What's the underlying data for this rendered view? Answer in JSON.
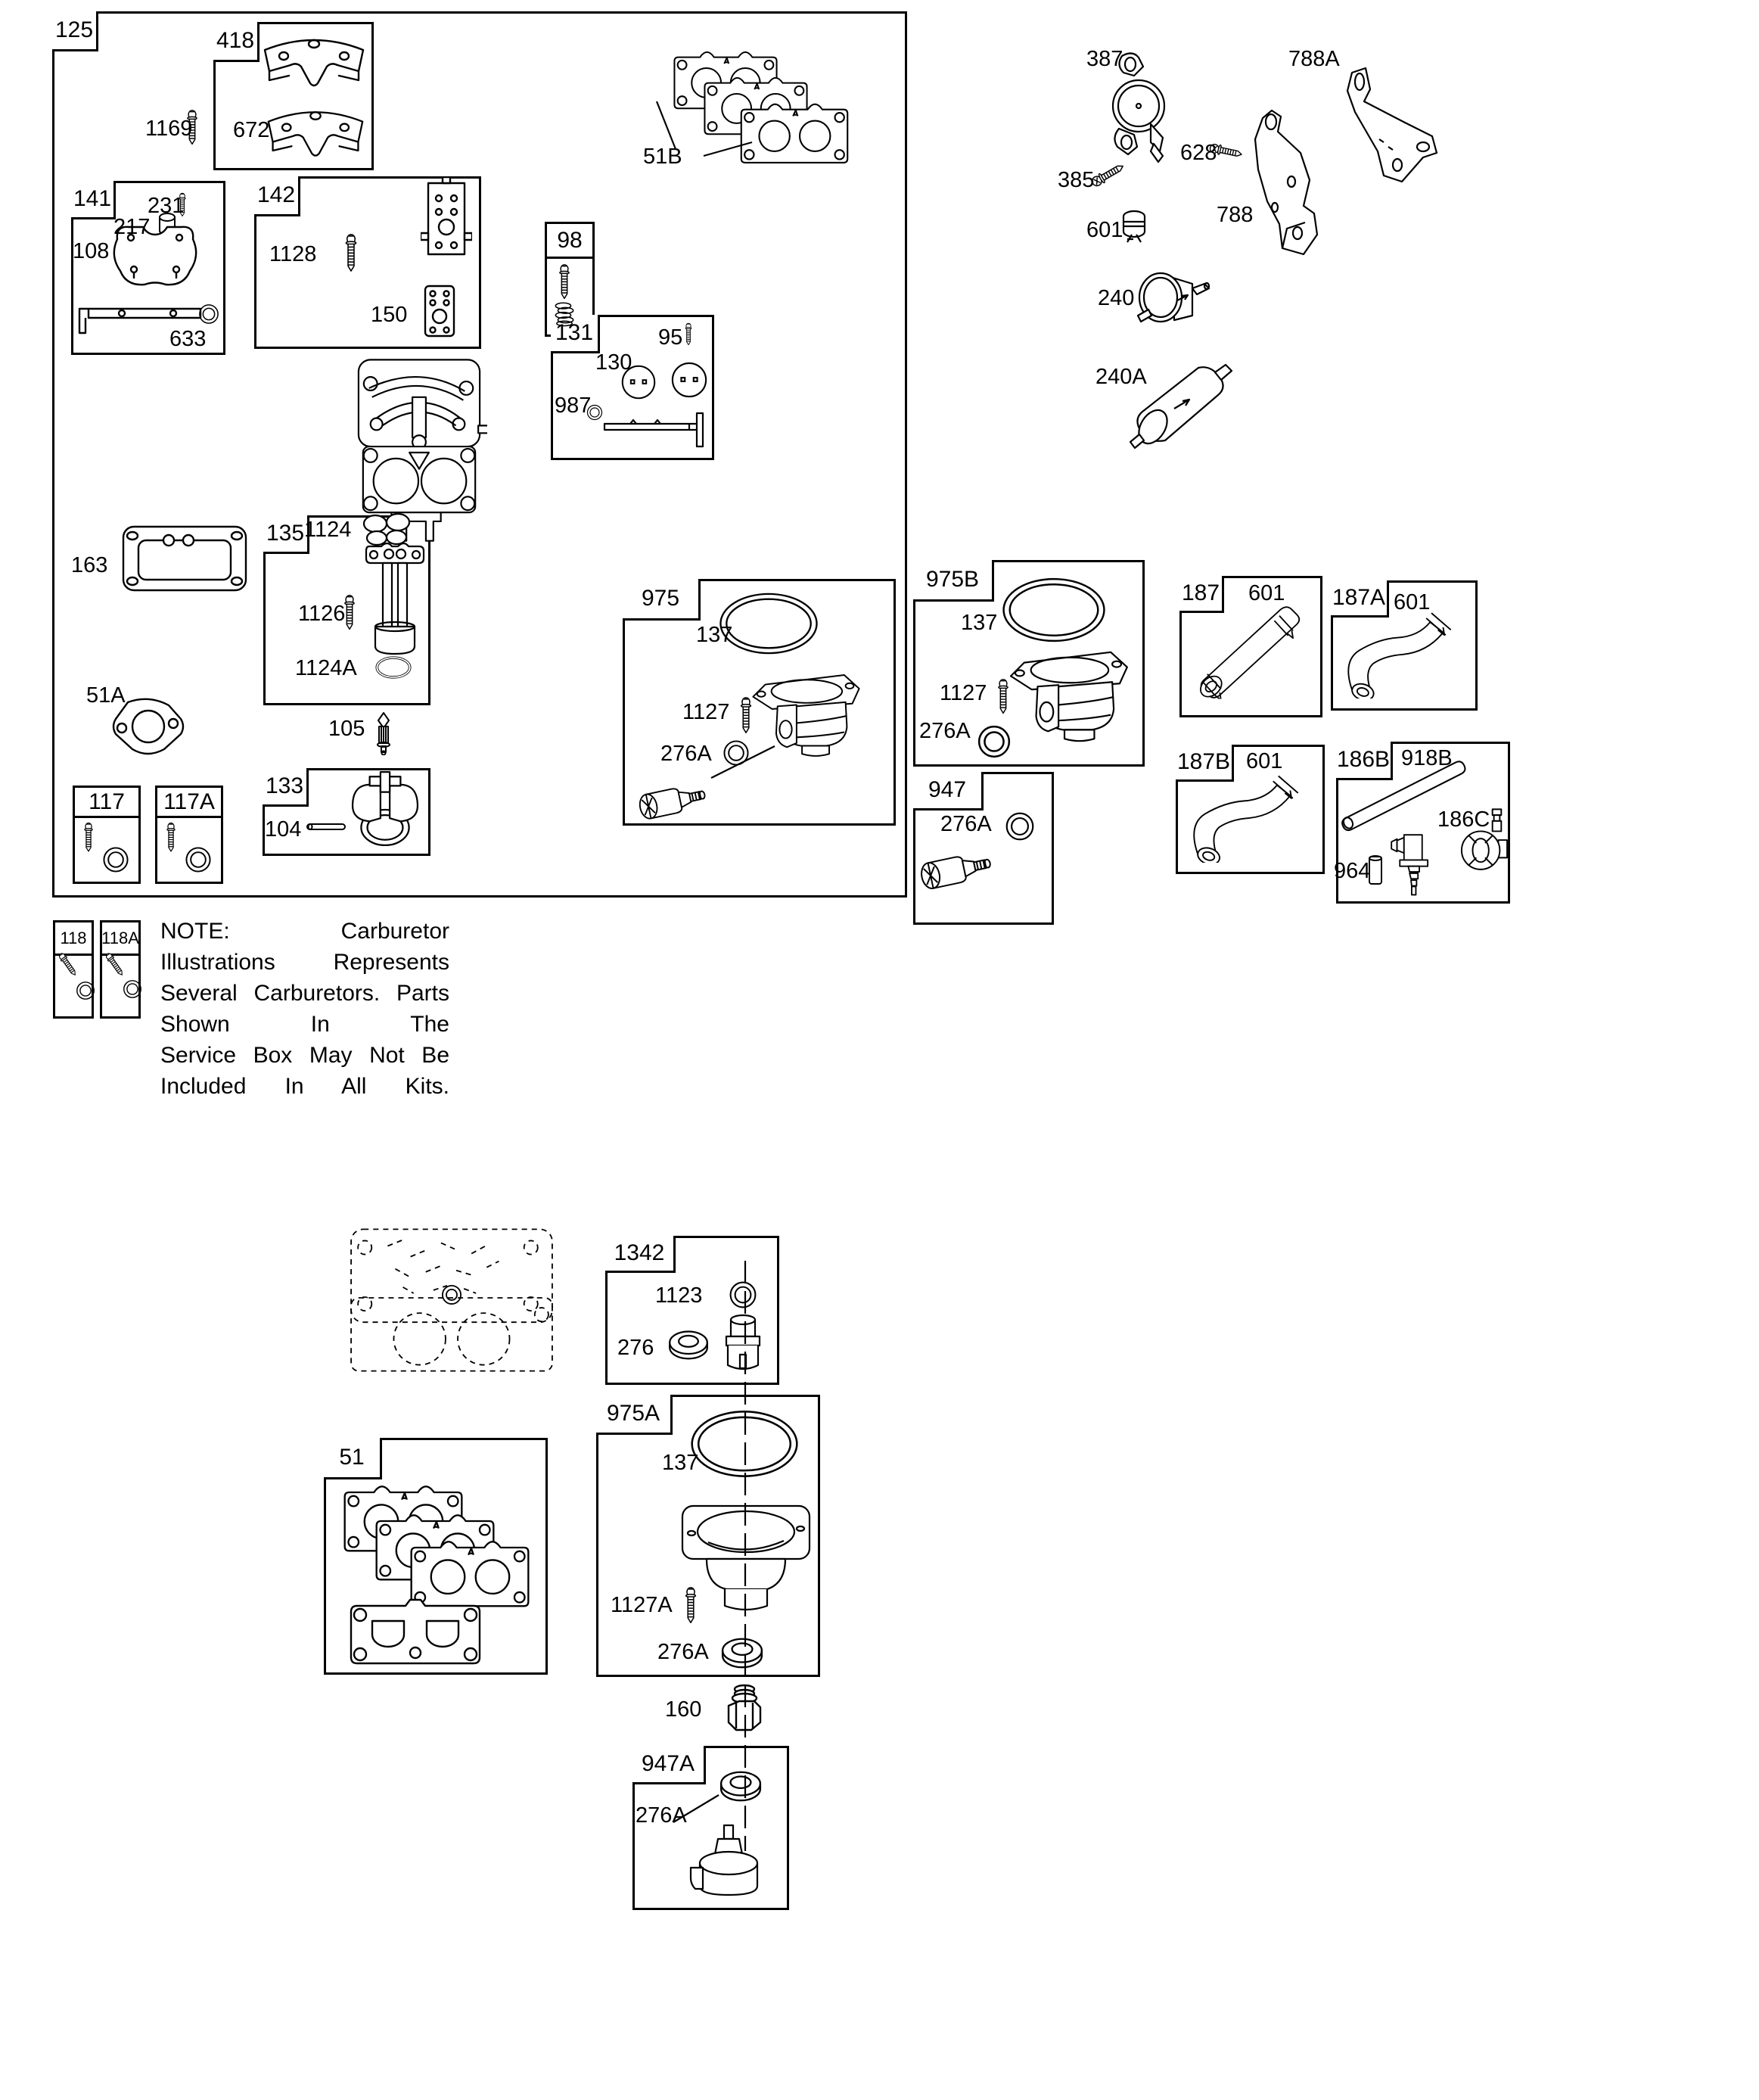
{
  "texts": {
    "box125": "125",
    "box418": "418",
    "box141": "141",
    "box142": "142",
    "box98": "98",
    "box131": "131",
    "box135": "135",
    "box133": "133",
    "box117": "117",
    "box117A": "117A",
    "box118": "118",
    "box118A": "118A",
    "box975": "975",
    "box975B": "975B",
    "box947": "947",
    "box187": "187",
    "box187A": "187A",
    "box187B": "187B",
    "box186B": "186B",
    "box1342": "1342",
    "box51": "51",
    "box975A": "975A",
    "box947A": "947A",
    "p1169": "1169",
    "p672": "672",
    "p51B": "51B",
    "p231": "231",
    "p217": "217",
    "p108": "108",
    "p633": "633",
    "p1128": "1128",
    "p150": "150",
    "p95": "95",
    "p130": "130",
    "p987": "987",
    "p387": "387",
    "p788A": "788A",
    "p628": "628",
    "p385": "385",
    "p601": "601",
    "p788": "788",
    "p240": "240",
    "p240A": "240A",
    "p163": "163",
    "p1124": "1124",
    "p1126": "1126",
    "p1124A": "1124A",
    "p51A": "51A",
    "p105": "105",
    "p104": "104",
    "p137_975": "137",
    "p1127_975": "1127",
    "p276A_975": "276A",
    "p137_975B": "137",
    "p1127_975B": "1127",
    "p276A_975B": "276A",
    "p276A_947": "276A",
    "p601_187": "601",
    "p601_187A": "601",
    "p601_187B": "601",
    "p918B": "918B",
    "p186C": "186C",
    "p964": "964",
    "p1123": "1123",
    "p276": "276",
    "p137_975A": "137",
    "p1127A": "1127A",
    "p276A_975A": "276A",
    "p160": "160",
    "p276A_947A": "276A"
  },
  "note": {
    "line1": "NOTE: Carburetor Illustrations Represents",
    "line2": "Several Carburetors. Parts Shown In The",
    "line3": "Service Box May Not Be Included In All Kits."
  },
  "colors": {
    "ink": "#000000",
    "background": "#ffffff"
  }
}
